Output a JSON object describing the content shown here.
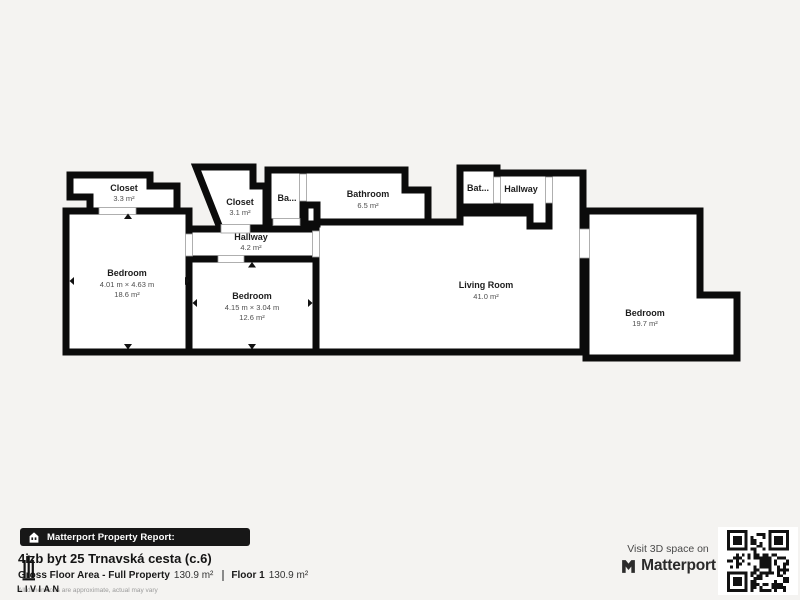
{
  "plan": {
    "wall_color": "#0b0b0b",
    "floor_color": "#ffffff",
    "rooms": [
      {
        "name": "Closet",
        "area": "3.3 m²"
      },
      {
        "name": "Closet",
        "area": "3.1 m²"
      },
      {
        "name": "Ba..."
      },
      {
        "name": "Bathroom",
        "area": "6.5 m²"
      },
      {
        "name": "Bat..."
      },
      {
        "name": "Hallway"
      },
      {
        "name": "Hallway",
        "area": "4.2 m²"
      },
      {
        "name": "Bedroom",
        "dims": "4.01 m × 4.63 m",
        "area": "18.6 m²"
      },
      {
        "name": "Bedroom",
        "dims": "4.15 m × 3.04 m",
        "area": "12.6 m²"
      },
      {
        "name": "Living Room",
        "area": "41.0 m²"
      },
      {
        "name": "Bedroom",
        "area": "19.7 m²"
      }
    ]
  },
  "footer": {
    "report_bar": {
      "label": "Matterport Property Report:"
    },
    "property": {
      "title": "4izb byt 25 Trnavská cesta (c.6)"
    },
    "stats": {
      "gross_label": "Gross Floor Area - Full Property",
      "gross_value": "130.9 m²",
      "floor_label": "Floor 1",
      "floor_value": "130.9 m²"
    },
    "disclaimer": "All dimensions are approximate, actual may vary",
    "watermark": "LIVIAN",
    "cta": {
      "line": "Visit 3D space on",
      "brand": "Matterport"
    }
  },
  "colors": {
    "background": "#f4f3f1",
    "bar": "#171717"
  }
}
